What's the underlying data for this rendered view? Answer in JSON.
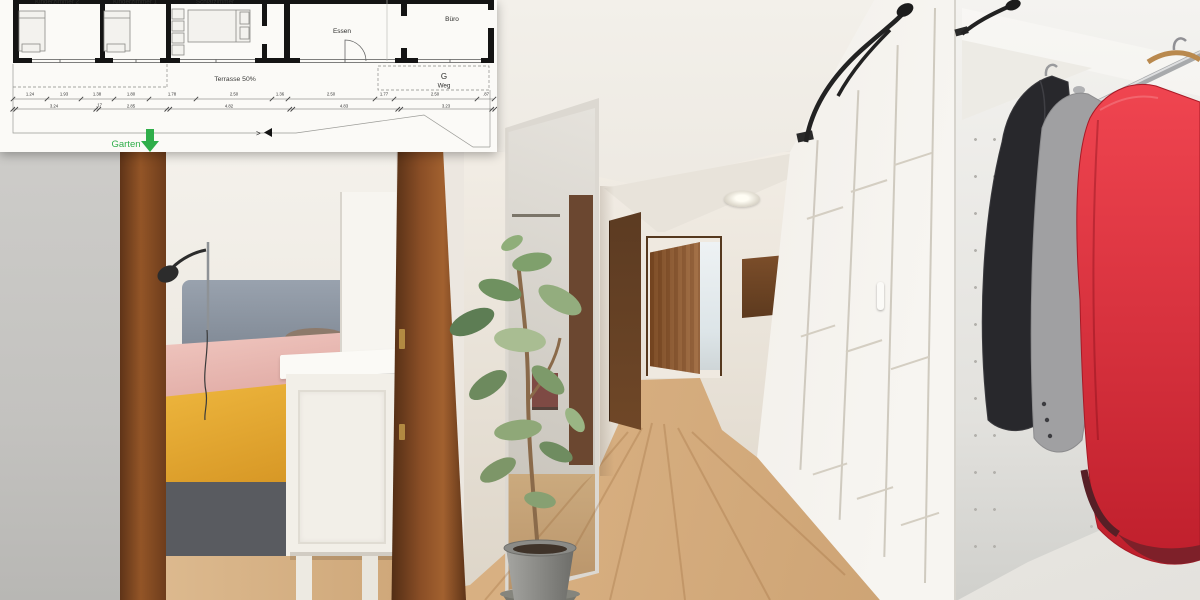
{
  "floor_plan": {
    "room_labels": [
      "Kinderzimmer 2",
      "Kinderzimmer 1",
      "Schlafzimmer",
      "Essen",
      "Büro"
    ],
    "terrace_label": "Terrasse 50%",
    "garage_label": "G",
    "path_label": "Weg",
    "garden_label": "Garten",
    "section_marker": ">",
    "dimensions_top": [
      "1.24",
      "1.93",
      "1.38",
      "1.80",
      "1.78",
      "2.50",
      "1.36",
      "2.50",
      "1.77",
      "2.50",
      ".87"
    ],
    "dimensions_bottom": [
      "3.24",
      ".17",
      "2.85",
      "4.82",
      "4.83",
      "3.23"
    ],
    "colors": {
      "garden_green": "#2fae4a",
      "wall_black": "#141414",
      "paper_white": "#fbfaf7"
    }
  },
  "photo": {
    "colors": {
      "door_frame_wood": "#8a4e26",
      "floor_oak": "#d9b183",
      "headboard_grey": "#8d96a2",
      "blanket_mustard": "#e2a42e",
      "bedding_pink": "#e8bcb6",
      "wardrobe_white": "#f3f1ed",
      "jacket_red": "#e03541",
      "jacket_black": "#28282c",
      "sweater_grey": "#a0a0a2",
      "plant_green": "#6d8a60",
      "pot_grey": "#8b8b87",
      "corridor_door_wood": "#8a5328",
      "closed_door_wood": "#5c3b22"
    }
  }
}
